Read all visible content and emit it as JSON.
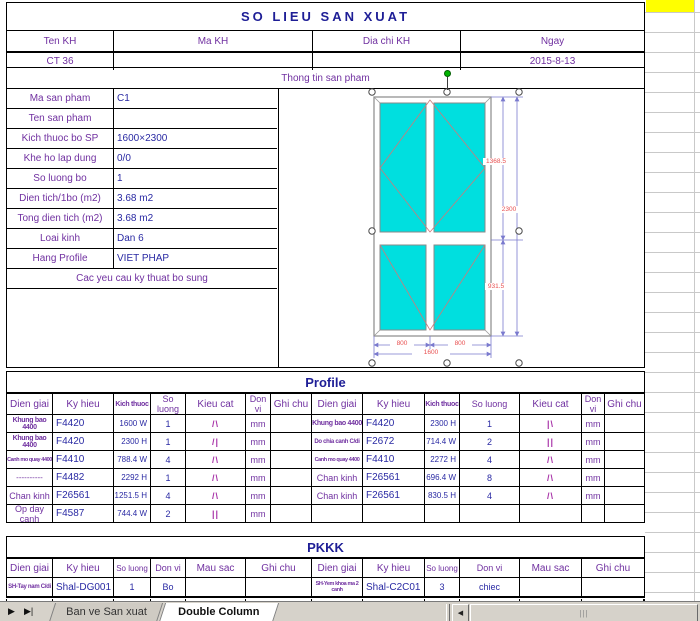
{
  "page_title": "SO LIEU SAN XUAT",
  "customer": {
    "headers": [
      "Ten KH",
      "Ma KH",
      "Dia chi KH",
      "Ngay"
    ],
    "values": [
      "CT 36",
      "",
      "",
      "2015-8-13"
    ],
    "section_label": "Thong tin san pham"
  },
  "product_info": {
    "rows": [
      {
        "label": "Ma san pham",
        "value": "C1"
      },
      {
        "label": "Ten san pham",
        "value": ""
      },
      {
        "label": "Kich thuoc bo SP",
        "value": "1600×2300"
      },
      {
        "label": "Khe ho lap dung",
        "value": "0/0"
      },
      {
        "label": "So luong bo",
        "value": "1"
      },
      {
        "label": "Dien tich/1bo (m2)",
        "value": "3.68 m2"
      },
      {
        "label": "Tong dien tich (m2)",
        "value": "3.68 m2"
      },
      {
        "label": "Loai kinh",
        "value": "Dan 6"
      },
      {
        "label": "Hang Profile",
        "value": "VIET PHAP"
      }
    ],
    "footer_note": "Cac yeu cau ky thuat bo sung"
  },
  "drawing": {
    "dim_upper_height": "1368.5",
    "dim_total_height": "2300",
    "dim_lower_height": "931.5",
    "dim_left_width": "800",
    "dim_right_width": "800",
    "dim_total_width": "1600"
  },
  "profile": {
    "section_title": "Profile",
    "headers": [
      "Dien giai",
      "Ky hieu",
      "Kich thuoc",
      "So luong",
      "Kieu cat",
      "Don vi",
      "Ghi chu"
    ],
    "left_rows": [
      {
        "dien_giai": "Khung bao 4400",
        "ky_hieu": "F4420",
        "kich_thuoc": "1600 W",
        "so_luong": "1",
        "kieu_cat": "/\\",
        "don_vi": "mm",
        "ghi_chu": ""
      },
      {
        "dien_giai": "Khung bao 4400",
        "ky_hieu": "F4420",
        "kich_thuoc": "2300 H",
        "so_luong": "1",
        "kieu_cat": "/|",
        "don_vi": "mm",
        "ghi_chu": ""
      },
      {
        "dien_giai": "Canh mo quay 4400",
        "ky_hieu": "F4410",
        "kich_thuoc": "788.4 W",
        "so_luong": "4",
        "kieu_cat": "/\\",
        "don_vi": "mm",
        "ghi_chu": ""
      },
      {
        "dien_giai": "----------",
        "ky_hieu": "F4482",
        "kich_thuoc": "2292 H",
        "so_luong": "1",
        "kieu_cat": "/\\",
        "don_vi": "mm",
        "ghi_chu": ""
      },
      {
        "dien_giai": "Chan kinh",
        "ky_hieu": "F26561",
        "kich_thuoc": "1251.5 H",
        "so_luong": "4",
        "kieu_cat": "/\\",
        "don_vi": "mm",
        "ghi_chu": ""
      },
      {
        "dien_giai": "Op day canh",
        "ky_hieu": "F4587",
        "kich_thuoc": "744.4 W",
        "so_luong": "2",
        "kieu_cat": "||",
        "don_vi": "mm",
        "ghi_chu": ""
      }
    ],
    "right_rows": [
      {
        "dien_giai": "Khung bao 4400",
        "ky_hieu": "F4420",
        "kich_thuoc": "2300 H",
        "so_luong": "1",
        "kieu_cat": "|\\",
        "don_vi": "mm",
        "ghi_chu": ""
      },
      {
        "dien_giai": "Do chia canh C/di",
        "ky_hieu": "F2672",
        "kich_thuoc": "714.4 W",
        "so_luong": "2",
        "kieu_cat": "||",
        "don_vi": "mm",
        "ghi_chu": ""
      },
      {
        "dien_giai": "Canh mo quay 4400",
        "ky_hieu": "F4410",
        "kich_thuoc": "2272 H",
        "so_luong": "4",
        "kieu_cat": "/\\",
        "don_vi": "mm",
        "ghi_chu": ""
      },
      {
        "dien_giai": "Chan kinh",
        "ky_hieu": "F26561",
        "kich_thuoc": "696.4 W",
        "so_luong": "8",
        "kieu_cat": "/\\",
        "don_vi": "mm",
        "ghi_chu": ""
      },
      {
        "dien_giai": "Chan kinh",
        "ky_hieu": "F26561",
        "kich_thuoc": "830.5 H",
        "so_luong": "4",
        "kieu_cat": "/\\",
        "don_vi": "mm",
        "ghi_chu": ""
      },
      {
        "dien_giai": "",
        "ky_hieu": "",
        "kich_thuoc": "",
        "so_luong": "",
        "kieu_cat": "",
        "don_vi": "",
        "ghi_chu": ""
      }
    ]
  },
  "pkkk": {
    "section_title": "PKKK",
    "headers": [
      "Dien giai",
      "Ky hieu",
      "So luong",
      "Don vi",
      "Mau sac",
      "Ghi chu"
    ],
    "left_row": {
      "dien_giai": "SH-Tay nam C/di",
      "ky_hieu": "Shal-DG001",
      "so_luong": "1",
      "don_vi": "Bo",
      "mau_sac": "",
      "ghi_chu": ""
    },
    "right_row": {
      "dien_giai": "SH-Yem khoa ma 2 canh",
      "ky_hieu": "Shal-C2C01",
      "so_luong": "3",
      "don_vi": "chiec",
      "mau_sac": "",
      "ghi_chu": ""
    }
  },
  "tabbar": {
    "nav_next_icon": "▶",
    "nav_last_icon": "▶|",
    "tabs": [
      "Ban ve San xuat",
      "Double Column"
    ],
    "active_tab": "Double Column",
    "scroll_left_icon": "◀",
    "thumb_grip": "|||"
  },
  "colors": {
    "label_purple": "#7030A0",
    "value_navy": "#2929A3",
    "cut_magenta": "#A833A8",
    "dim_red": "#E85050",
    "dim_line_blue": "#7a7ace",
    "glass_cyan": "#00DFDF",
    "highlight_yellow": "#FFFF00"
  }
}
